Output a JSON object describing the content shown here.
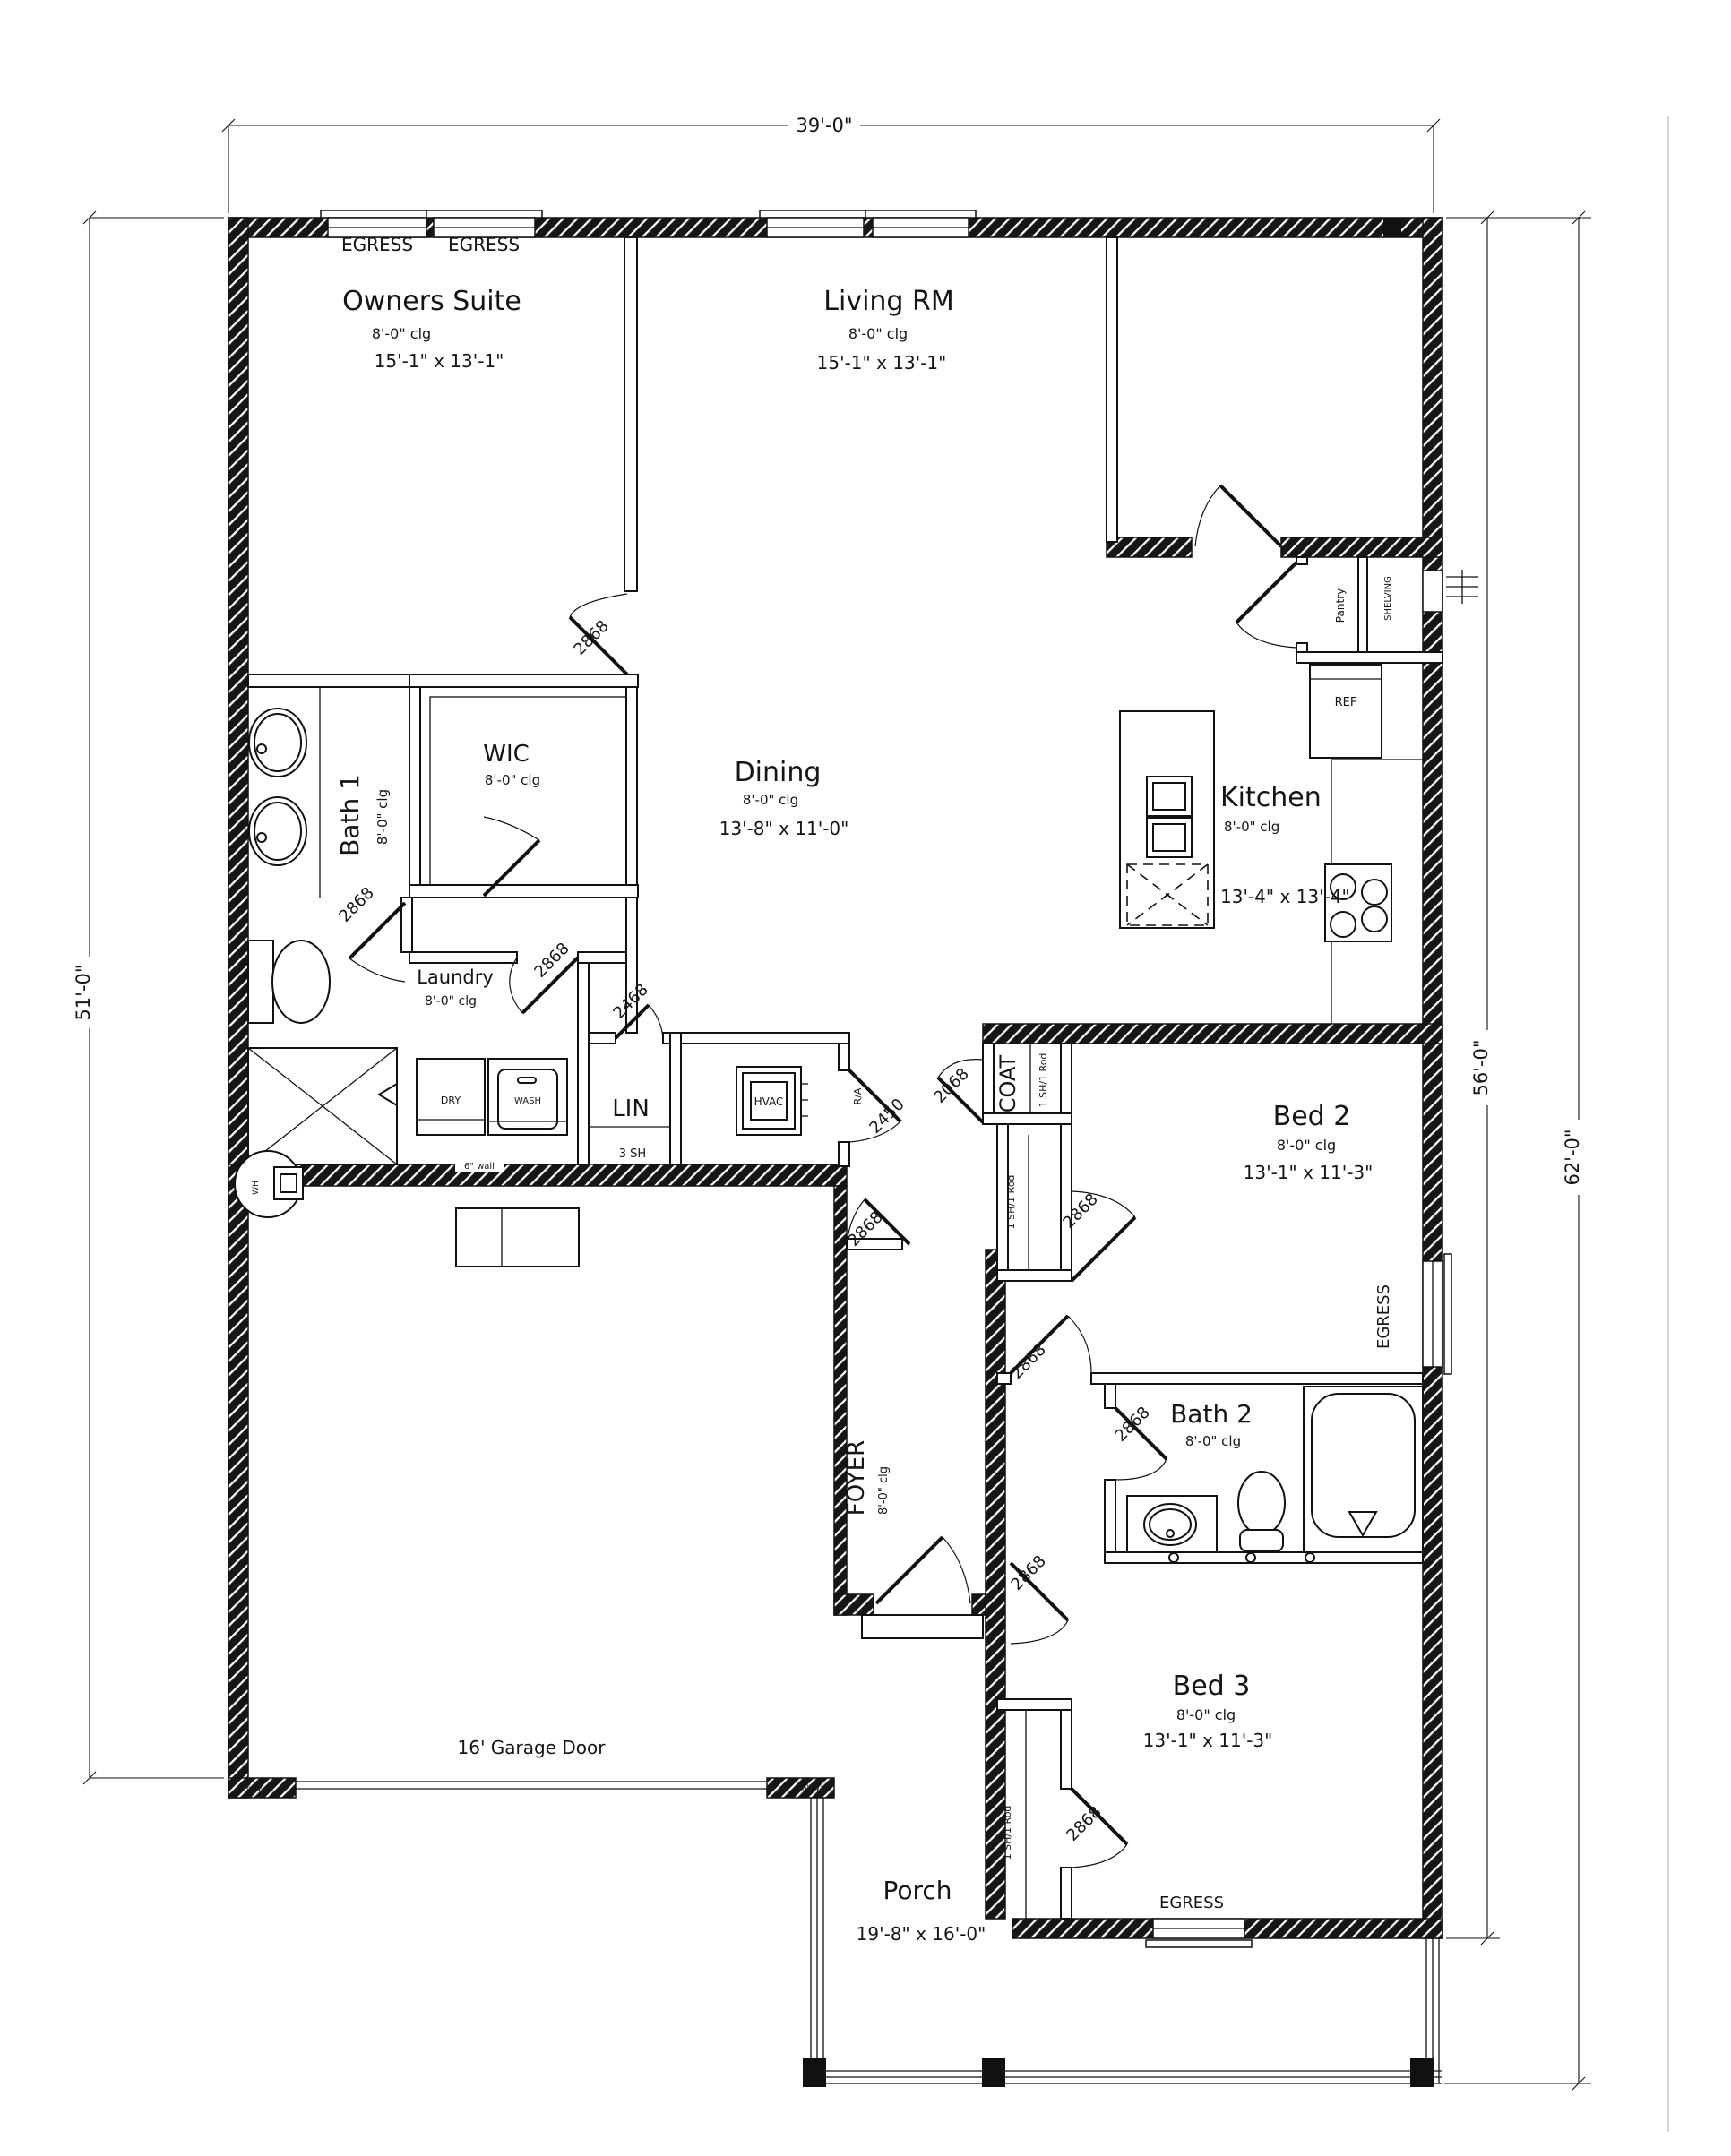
{
  "sheet": {
    "background": "#ffffff",
    "line_color": "#151515"
  },
  "dimensions": {
    "overall_width": "39'-0\"",
    "left_height": "51'-0\"",
    "right_depth_inner": "56'-0\"",
    "right_depth_outer": "62'-0\""
  },
  "labels": {
    "egress": "EGRESS",
    "six_inch_wall": "6\" wall",
    "garage_door": "16' Garage Door",
    "water_heater": "WH",
    "return_air": "R/A",
    "ref": "REF",
    "dryer": "DRY",
    "washer": "WASH",
    "shelf_3": "3 SH",
    "shelf_rod": "1 SH/1 Rod",
    "pantry": "Pantry",
    "shelving": "SHELVING"
  },
  "doors": {
    "d2868": "2868",
    "d2468": "2468",
    "d2450": "2450",
    "d2068": "2068"
  },
  "rooms": {
    "owners_suite": {
      "name": "Owners Suite",
      "clg": "8'-0\" clg",
      "size": "15'-1\" x 13'-1\""
    },
    "living": {
      "name": "Living RM",
      "clg": "8'-0\" clg",
      "size": "15'-1\" x 13'-1\""
    },
    "dining": {
      "name": "Dining",
      "clg": "8'-0\" clg",
      "size": "13'-8\" x 11'-0\""
    },
    "kitchen": {
      "name": "Kitchen",
      "clg": "8'-0\" clg",
      "size": "13'-4\" x 13'-4\""
    },
    "bath1": {
      "name": "Bath 1",
      "clg": "8'-0\" clg"
    },
    "wic": {
      "name": "WIC",
      "clg": "8'-0\" clg"
    },
    "laundry": {
      "name": "Laundry",
      "clg": "8'-0\" clg"
    },
    "lin": {
      "name": "LIN"
    },
    "hvac": {
      "name": "HVAC"
    },
    "coat": {
      "name": "COAT"
    },
    "bed2": {
      "name": "Bed 2",
      "clg": "8'-0\" clg",
      "size": "13'-1\" x 11'-3\""
    },
    "bath2": {
      "name": "Bath 2",
      "clg": "8'-0\" clg"
    },
    "bed3": {
      "name": "Bed 3",
      "clg": "8'-0\" clg",
      "size": "13'-1\" x 11'-3\""
    },
    "foyer": {
      "name": "FOYER",
      "clg": "8'-0\" clg"
    },
    "porch": {
      "name": "Porch",
      "size": "19'-8\" x 16'-0\""
    }
  }
}
